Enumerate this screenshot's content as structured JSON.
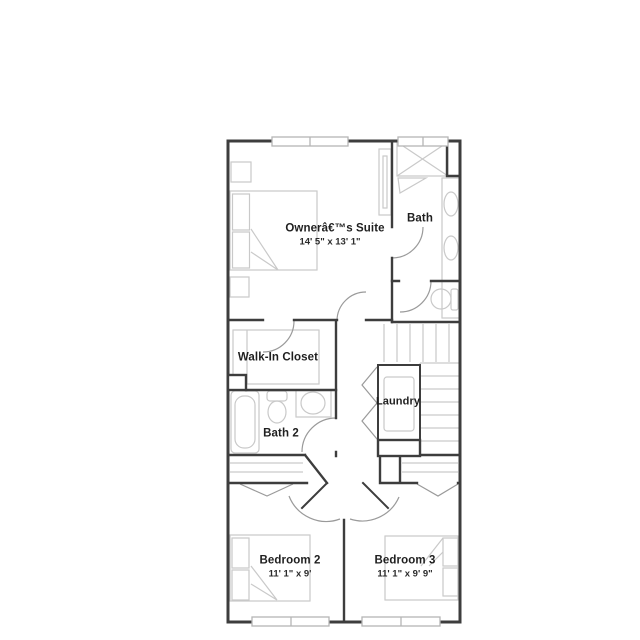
{
  "floor_plan": {
    "background": "#ffffff",
    "colors": {
      "wall": "#3d3d3d",
      "fixture_line": "#c9c9c9",
      "door_arc": "#9a9a9a",
      "window_frame": "#b5b5b5",
      "text": "#1f1f1f"
    },
    "labels": {
      "owners_suite": {
        "name": "Ownerâ€™s Suite",
        "dims": "14' 5\" x 13' 1\""
      },
      "bath": {
        "name": "Bath"
      },
      "walk_in_closet": {
        "name": "Walk-In Closet"
      },
      "laundry": {
        "name": "Laundry"
      },
      "bath_2": {
        "name": "Bath 2"
      },
      "bedroom_2": {
        "name": "Bedroom 2",
        "dims": "11' 1\" x 9'"
      },
      "bedroom_3": {
        "name": "Bedroom 3",
        "dims": "11' 1\" x 9' 9\""
      }
    },
    "fixtures": [
      "bed",
      "nightstand",
      "wardrobe",
      "shower",
      "double-sink-vanity",
      "toilet",
      "bathtub",
      "sink",
      "washer",
      "stairs",
      "bifold-closet-door",
      "window",
      "door-swing"
    ]
  }
}
